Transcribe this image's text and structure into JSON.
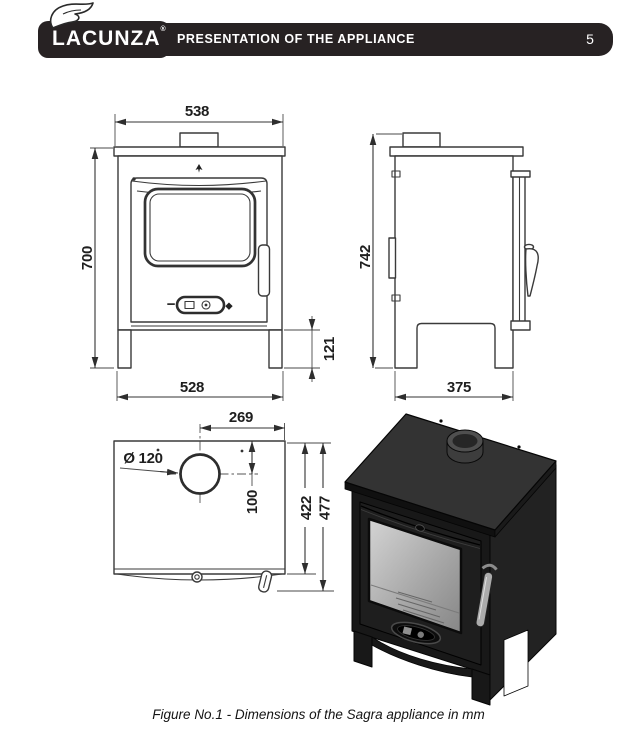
{
  "header": {
    "brand": "LACUNZA",
    "registered_mark": "®",
    "title": "PRESENTATION OF THE APPLIANCE",
    "page_number": "5",
    "bar_color": "#272223",
    "text_color": "#ffffff"
  },
  "figure": {
    "caption": "Figure No.1 - Dimensions of the Sagra appliance in mm",
    "units": "mm",
    "line_color": "#3a3a3a",
    "views": {
      "front": {
        "dims": {
          "top_width": "538",
          "height": "700",
          "bottom_width": "528",
          "leg_height": "121"
        },
        "air_control": {
          "minus": "−",
          "plus": "◆"
        }
      },
      "side": {
        "dims": {
          "height": "742",
          "depth": "375"
        }
      },
      "top": {
        "dims": {
          "flue_offset_to_side": "269",
          "flue_diameter": "Ø 120",
          "flue_center_depth": "100",
          "body_depth": "422",
          "overall_depth": "477"
        }
      },
      "perspective": {
        "description": "3d-stove-rendering"
      }
    }
  }
}
